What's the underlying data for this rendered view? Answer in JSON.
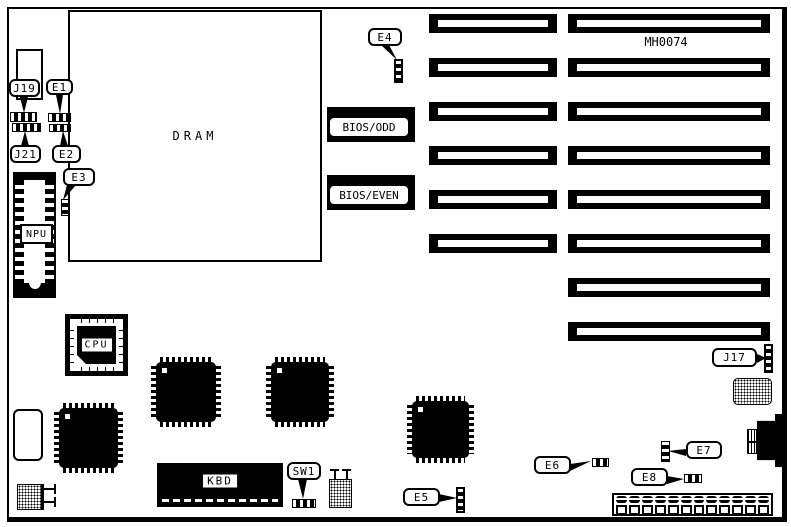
{
  "diagram": {
    "board_id": "MH0074",
    "chips": {
      "dram": "DRAM",
      "npu": "NPU",
      "cpu": "CPU",
      "kbd": "KBD",
      "bios_odd": "BIOS/ODD",
      "bios_even": "BIOS/EVEN"
    },
    "jumper_labels": {
      "j19": "J19",
      "e1": "E1",
      "j21": "J21",
      "e2": "E2",
      "e3": "E3",
      "e4": "E4",
      "sw1": "SW1",
      "e5": "E5",
      "e6": "E6",
      "e7": "E7",
      "e8": "E8",
      "j17": "J17"
    },
    "expansion_slots": {
      "left_column_count": 6,
      "right_column_count": 8
    },
    "power_connector": {
      "oval_pin_count": 12,
      "square_pin_count": 12
    },
    "colors": {
      "ink": "#000000",
      "paper": "#ffffff"
    }
  }
}
